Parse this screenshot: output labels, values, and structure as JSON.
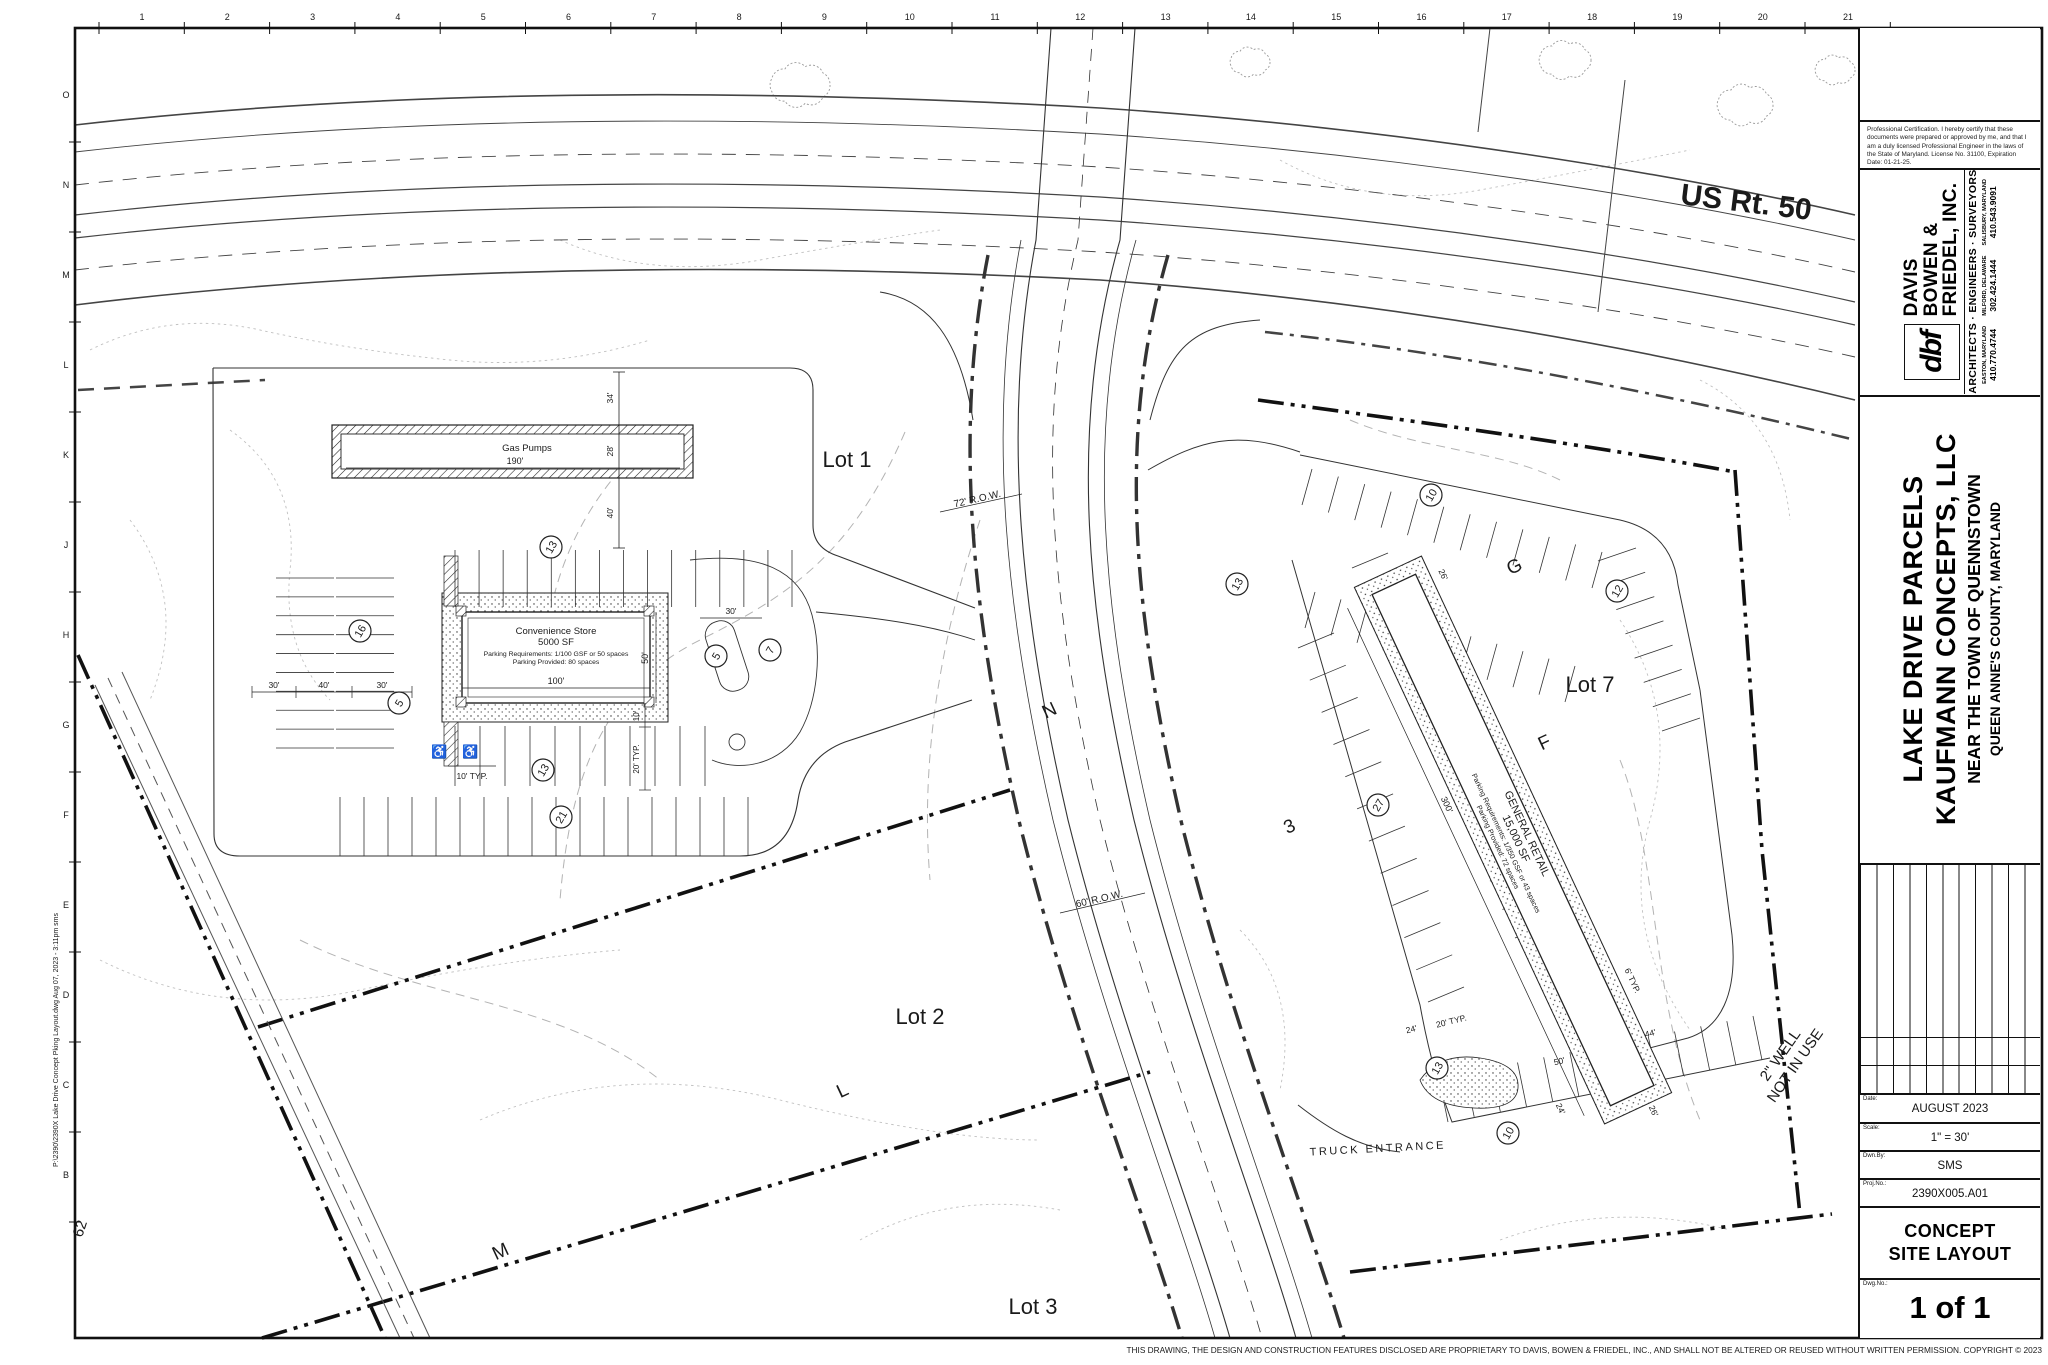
{
  "sheet": {
    "footer_disclaimer": "THIS DRAWING, THE DESIGN AND CONSTRUCTION FEATURES DISCLOSED ARE PROPRIETARY TO DAVIS, BOWEN & FRIEDEL, INC., AND SHALL NOT BE ALTERED OR REUSED WITHOUT WRITTEN PERMISSION. COPYRIGHT © 2023",
    "edge_note": "P:\\2390\\2390X Lake Drive Concept Pking Layout.dwg  Aug 07, 2023 - 3:11pm sms"
  },
  "border": {
    "cols": [
      "1",
      "2",
      "3",
      "4",
      "5",
      "6",
      "7",
      "8",
      "9",
      "10",
      "11",
      "12",
      "13",
      "14",
      "15",
      "16",
      "17",
      "18",
      "19",
      "20",
      "21"
    ],
    "rows": [
      "O",
      "N",
      "M",
      "L",
      "K",
      "J",
      "H",
      "G",
      "F",
      "E",
      "D",
      "C",
      "B"
    ]
  },
  "plan": {
    "highway_label": "US Rt. 50",
    "lots": {
      "lot1": "Lot 1",
      "lot2": "Lot 2",
      "lot3": "Lot 3",
      "lot7": "Lot 7"
    },
    "gas_canopy": {
      "label": "Gas Pumps",
      "length": "190'"
    },
    "store": {
      "line1": "Convenience Store",
      "line2": "5000 SF",
      "line3": "Parking Requirements: 1/100 GSF or 50 spaces",
      "line4": "Parking Provided: 80 spaces"
    },
    "retail": {
      "line1": "GENERAL RETAIL",
      "line2": "15,000 SF",
      "line3": "Parking Requirements: 1/350 GSF or 43 spaces",
      "line4": "Parking Provided: 72 spaces"
    },
    "row72": "72' R.O.W.",
    "row60": "60' R.O.W.",
    "truck_entrance": "TRUCK ENTRANCE",
    "well_note": {
      "line1": "2\" WELL",
      "line2": "NOT IN USE"
    },
    "contour_label": "62",
    "keynotes": [
      "13",
      "16",
      "5",
      "5",
      "7",
      "13",
      "21",
      "13",
      "10",
      "12",
      "27",
      "13",
      "10"
    ],
    "road_letters": [
      "N",
      "G",
      "F",
      "L",
      "M",
      "3"
    ],
    "dims": {
      "d190": "190'",
      "d34": "34'",
      "d28": "28'",
      "d40": "40'",
      "d100": "100'",
      "d50": "50'",
      "d30": "30'",
      "d10": "10'",
      "d10t": "10' TYP.",
      "d20t": "20' TYP.",
      "d300": "300'",
      "d24": "24'",
      "d26": "26'",
      "d44": "44'",
      "d6t": "6' TYP."
    }
  },
  "titleblock": {
    "certification": "Professional Certification. I hereby certify that these documents were prepared or approved by me, and that I am a duly licensed Professional Engineer in the laws of the State of Maryland. License No. 31100, Expiration Date: 01-21-25.",
    "firm": {
      "logo": "dbf",
      "name1": "DAVIS",
      "name2": "BOWEN &",
      "name3": "FRIEDEL, INC.",
      "tagline": "ARCHITECTS · ENGINEERS · SURVEYORS",
      "offices": [
        {
          "city": "EASTON, MARYLAND",
          "phone": "410.770.4744"
        },
        {
          "city": "MILFORD, DELAWARE",
          "phone": "302.424.1444"
        },
        {
          "city": "SALISBURY, MARYLAND",
          "phone": "410.543.9091"
        }
      ]
    },
    "project": {
      "line1": "LAKE DRIVE PARCELS",
      "line2": "KAUFMANN CONCEPTS, LLC",
      "line3": "NEAR THE TOWN OF QUENNSTOWN",
      "line4": "QUEEN ANNE'S COUNTY, MARYLAND"
    },
    "fields": {
      "date_label": "Date:",
      "date": "AUGUST 2023",
      "scale_label": "Scale:",
      "scale": "1\" = 30'",
      "dwn_label": "Dwn.By:",
      "dwn": "SMS",
      "proj_label": "Proj.No.:",
      "proj": "2390X005.A01",
      "dwg_label": "Dwg.No.:",
      "sheet_no": "1 of 1"
    },
    "sheet_title1": "CONCEPT",
    "sheet_title2": "SITE LAYOUT"
  }
}
